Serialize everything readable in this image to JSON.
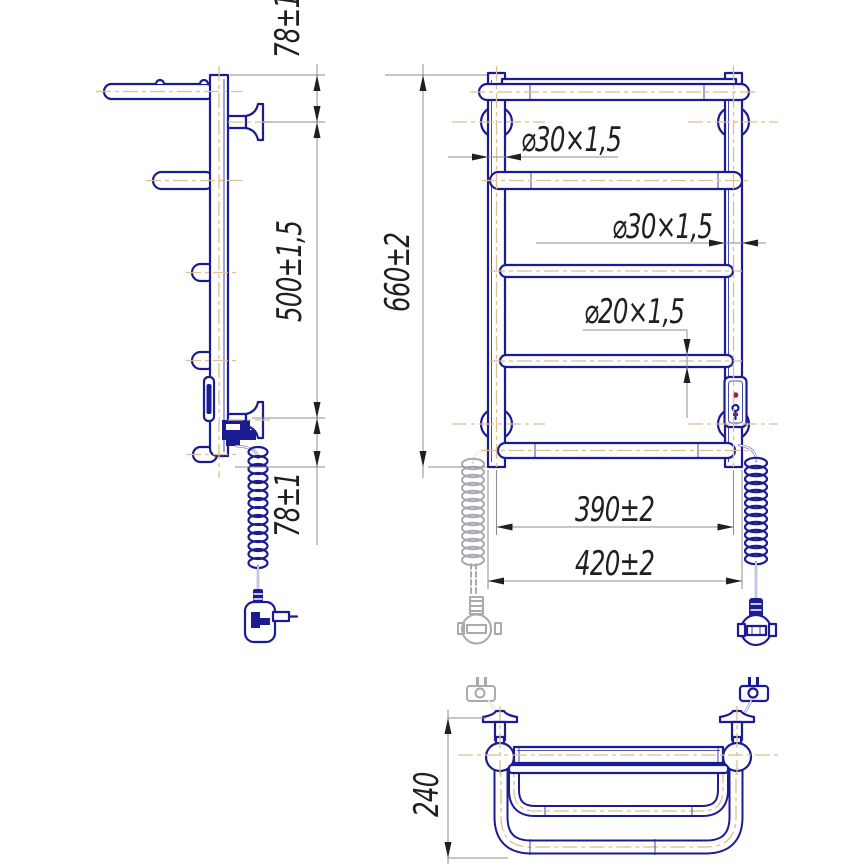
{
  "dimensions": {
    "top_offset": "78±1",
    "bracket_span": "500±1,5",
    "overall_height": "660±2",
    "bottom_offset": "78±1",
    "left_tube": "⌀30×1,5",
    "right_tube": "⌀30×1,5",
    "rung_tube": "⌀20×1,5",
    "axis_width": "390±2",
    "overall_width": "420±2",
    "shelf_depth": "240"
  },
  "colors": {
    "line": "#1c1c92",
    "centerline": "#dcbf92",
    "dimension": "#8d8d96",
    "phantom": "#a9a9b0",
    "text": "#1f1f1f",
    "accent_red": "#b5123a",
    "background": "#ffffff"
  }
}
